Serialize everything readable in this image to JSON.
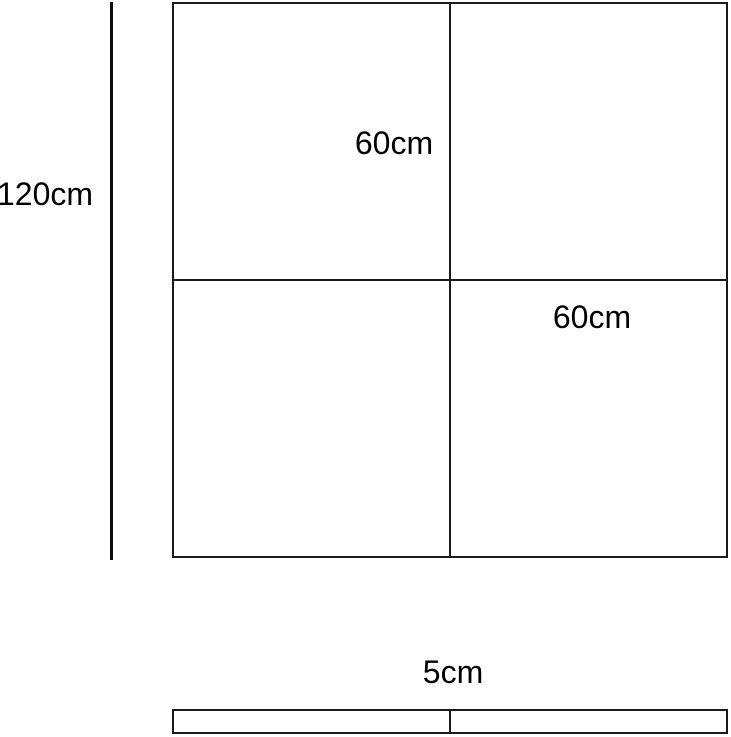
{
  "diagram": {
    "description": "Dimensioned drawing of a square tile panel divided into four equal quadrants, with a thin side profile strip below",
    "colors": {
      "background": "#ffffff",
      "line": "#1a1a1a",
      "text": "#000000"
    },
    "labels": {
      "overall_height": "120cm",
      "quadrant_top": "60cm",
      "quadrant_right": "60cm",
      "thickness": "5cm"
    },
    "dimensions": {
      "overall_height_cm": 120,
      "quadrant_size_cm": 60,
      "thickness_cm": 5
    }
  }
}
